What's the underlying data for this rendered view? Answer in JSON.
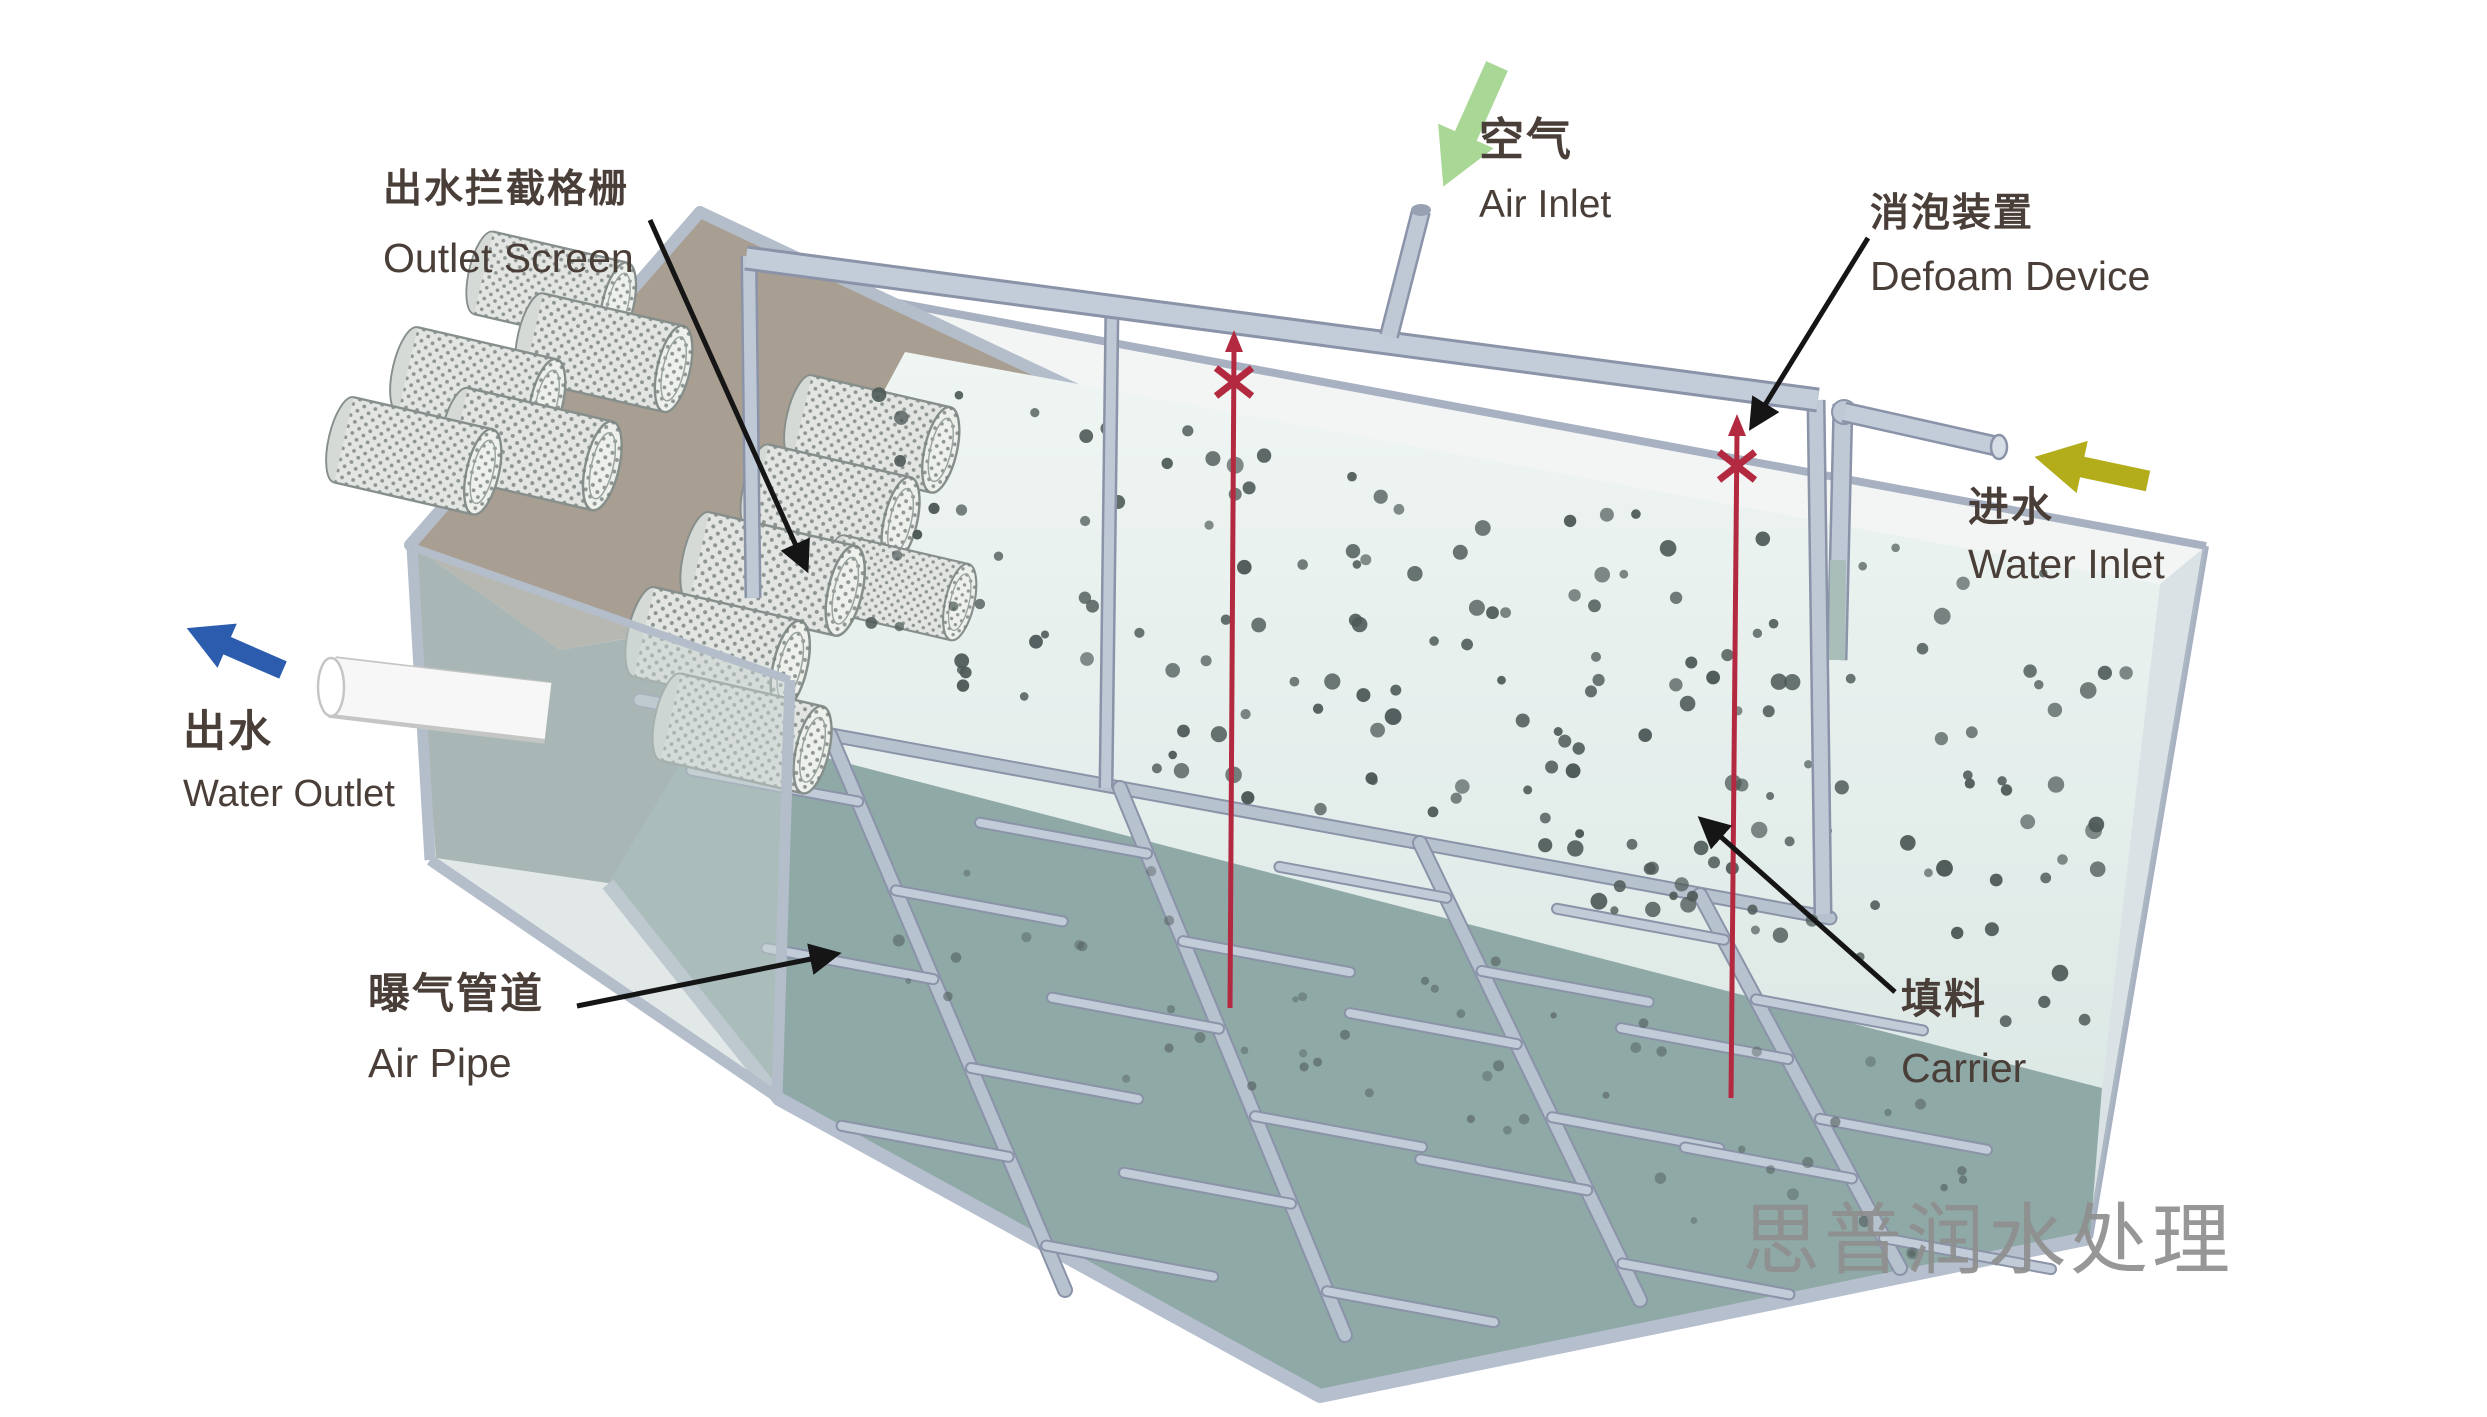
{
  "diagram": {
    "type": "3d-schematic",
    "subject": "MBBR aeration tank water-treatment process diagram",
    "watermark": "思普润水处理",
    "labels": {
      "outlet_screen": {
        "zh": "出水拦截格栅",
        "en": "Outlet Screen"
      },
      "air_inlet": {
        "zh": "空气",
        "en": "Air Inlet"
      },
      "defoam_device": {
        "zh": "消泡装置",
        "en": "Defoam Device"
      },
      "water_inlet": {
        "zh": "进水",
        "en": "Water Inlet"
      },
      "water_outlet": {
        "zh": "出水",
        "en": "Water Outlet"
      },
      "air_pipe": {
        "zh": "曝气管道",
        "en": "Air Pipe"
      },
      "carrier": {
        "zh": "填料",
        "en": "Carrier"
      }
    },
    "colors": {
      "air_arrow": "#a9d795",
      "inlet_arrow": "#b3ad1c",
      "outlet_arrow": "#2b5cad",
      "pointer_arrow": "#151515",
      "defoam_rod": "#b32a40",
      "water_surface": "#e7efed",
      "tank_floor": "#8fa9a7",
      "tank_wall_frame": "#b7c1cf",
      "back_wall": "#a89e92",
      "carrier_dot": "#4e5a58",
      "label_text": "#4a3e38",
      "watermark_text": "#8f8f8f"
    },
    "particles": {
      "water_count": 165,
      "edge_count": 18,
      "floor_count": 55
    }
  }
}
